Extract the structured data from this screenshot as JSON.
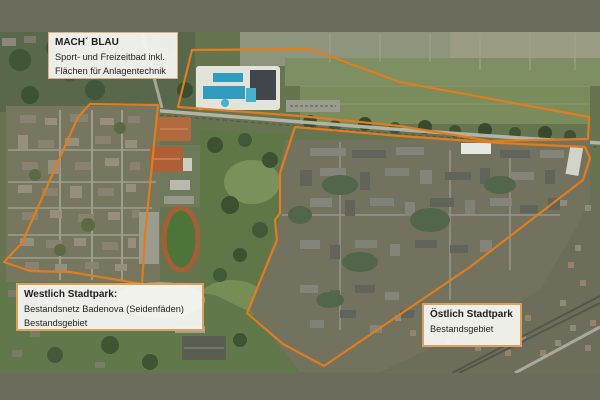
{
  "frame": {
    "background_color": "#6c6c5c"
  },
  "map": {
    "annotation_color": "#e07d1e",
    "labels": {
      "mach_blau": {
        "title": "MACH´ BLAU",
        "line1": "Sport- und Freizeitbad inkl.",
        "line2": "Flächen für Anlagentechnik"
      },
      "west": {
        "title": "Westlich Stadtpark:",
        "line1": "Bestandsnetz Badenova (Seidenfäden)",
        "line2": "Bestandsgebiet"
      },
      "east": {
        "title": "Östlich Stadtpark",
        "line1": "Bestandsgebiet"
      }
    },
    "regions": [
      {
        "name": "mach-blau-area",
        "points": "192,50 310,49 400,82 589,117 588,139 490,141 400,126 300,116 178,107"
      },
      {
        "name": "westlich-stadtpark-area",
        "points": "90,104 158,105 145,235 142,284 70,272 30,271 4,262 22,243 78,117"
      },
      {
        "name": "oestlich-stadtpark-area",
        "points": "295,127 400,136 500,143 585,147 590,158 583,180 470,267 324,366 283,344 247,313 277,240 275,220 280,213 280,173"
      }
    ]
  }
}
